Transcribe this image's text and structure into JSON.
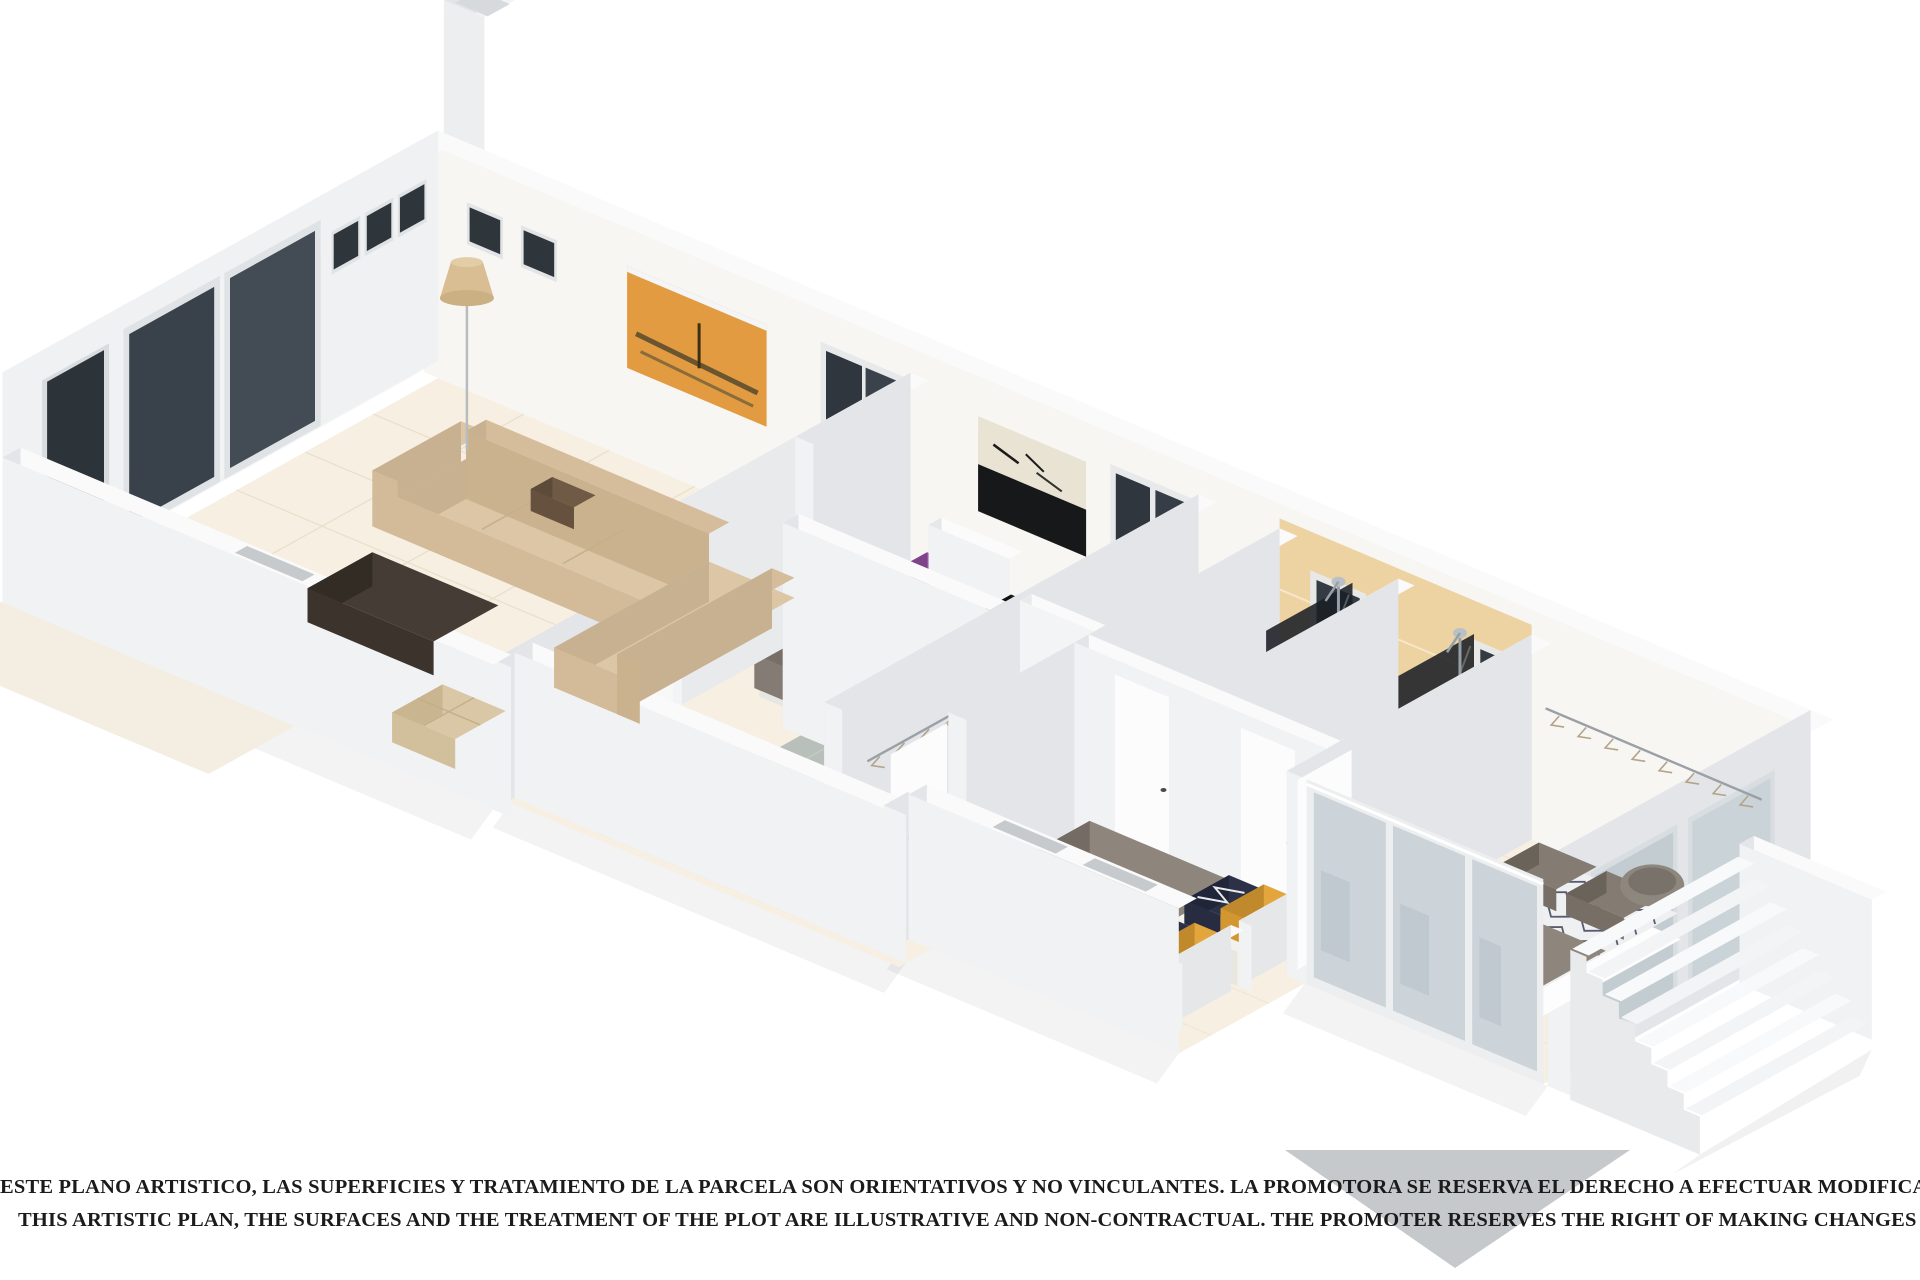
{
  "disclaimer": {
    "line1": "ESTE PLANO ARTISTICO, LAS SUPERFICIES Y TRATAMIENTO DE LA PARCELA SON ORIENTATIVOS Y NO VINCULANTES. LA PROMOTORA SE RESERVA EL DERECHO A EFECTUAR MODIFICACIONES POR CUALQUIER NECESIDAD",
    "line2": "THIS ARTISTIC PLAN, THE SURFACES AND THE TREATMENT OF THE PLOT ARE ILLUSTRATIVE AND NON-CONTRACTUAL. THE PROMOTER RESERVES THE RIGHT OF MAKING CHANGES DUE TO ANY NECESSITY"
  },
  "palette": {
    "background": "#ffffff",
    "text": "#1b1b1b",
    "wall_top": "#fafafb",
    "wall_south": "#f1f2f4",
    "wall_west": "#e3e5e8",
    "wall_interior": "#f7f6f3",
    "wall_exterior": "#f0f1f3",
    "floor_cream": "#f6efe2",
    "floor_grout": "#e9dfc9",
    "tile_gray": "#b9bfba",
    "tile_grout": "#c8cfc9",
    "wood": "#cfc1a1",
    "sofa": "#dcc6a6",
    "sofa_shade": "#c8b190",
    "table_dark": "#453d35",
    "mattress": "#f3f1ed",
    "blanket_gray": "#8e867d",
    "stripe_navy": "#2d3148",
    "pillow_purple": "#9b57a7",
    "pillow_yellow": "#e2a63d",
    "pillow_brown": "#6f5a45",
    "art_orange": "#e29b40",
    "art_dark": "#17181a",
    "tan_wall": "#edd2a2",
    "glass_dark": "#2f363e",
    "glass_light": "#ccd4d9",
    "chrome": "#97a0a6",
    "green": "#a6cf36",
    "cyan": "#4fc3d3",
    "shadow_triangle": "#c6c9cc"
  }
}
